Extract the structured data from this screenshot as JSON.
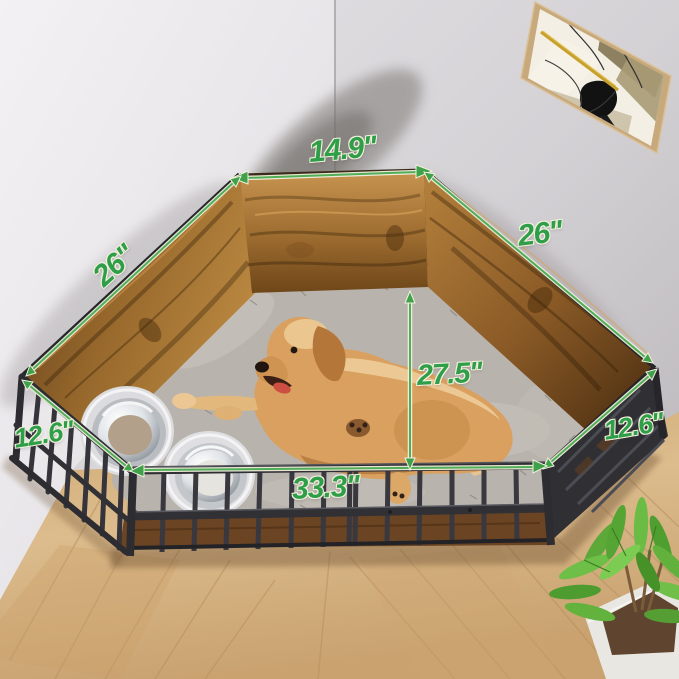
{
  "meta": {
    "description": "Product dimension photo of a corner dog playpen placed in a room corner with a golden retriever lying on a gray plush bed, two elevated stainless steel bowls, framed abstract wall art and a potted plant on a herringbone wood floor"
  },
  "dims": {
    "back": "14.9''",
    "left": "26''",
    "right": "26''",
    "front_left": "12.6''",
    "front_right": "12.6''",
    "height": "27.5''",
    "front": "33.3''"
  },
  "colors": {
    "dimension_text": "#2f9e48",
    "dimension_line": "#4fae57",
    "dimension_outline": "#f2efdd",
    "wood_panel": "#a87838",
    "metal_bars": "#36363c",
    "rug": "#b8b3ac",
    "floor": "#d6b585",
    "dog": "#d9a05f"
  },
  "scene": {
    "objects": [
      "corner wood playpen with metal bar front",
      "golden retriever dog",
      "gray plush pet bed",
      "two elevated stainless steel bowls",
      "framed abstract wall art",
      "potted green plant",
      "herringbone wood floor",
      "room corner walls"
    ]
  }
}
